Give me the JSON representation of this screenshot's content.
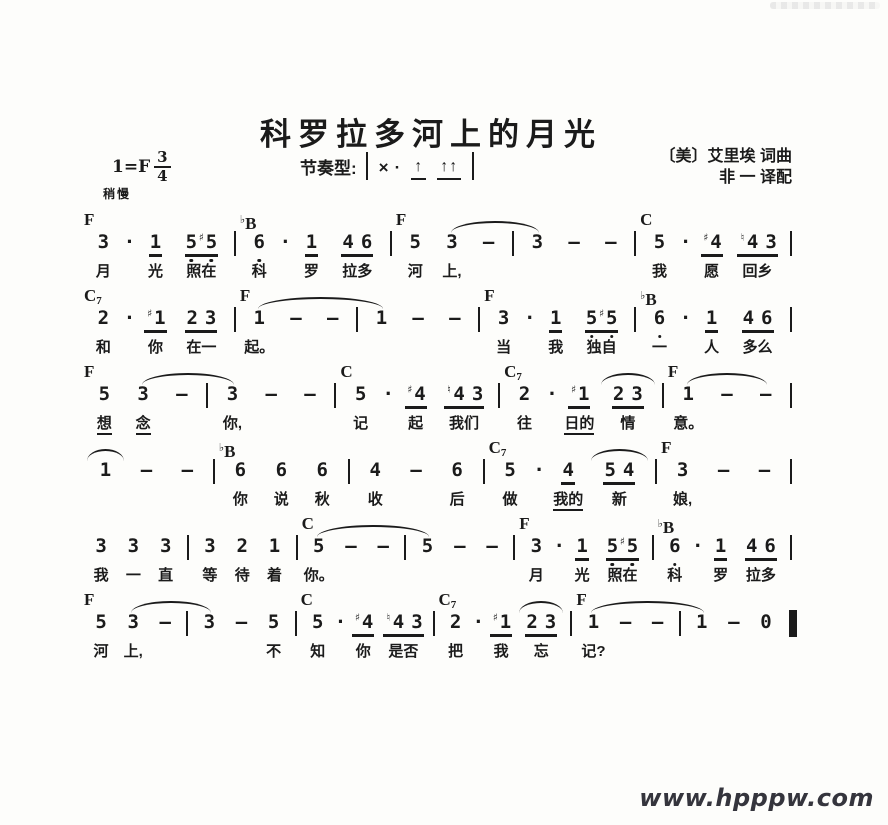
{
  "page": {
    "title": "科罗拉多河上的月光",
    "key_signature": "1=F",
    "time_numerator": "3",
    "time_denominator": "4",
    "tempo": "稍慢",
    "rhythm": {
      "label": "节奏型:",
      "x": "×",
      "dot": "·",
      "arrow": "↑",
      "arrow_pair": "↑↑"
    },
    "credit_line1": "〔美〕艾里埃 词曲",
    "credit_line2": "非 一 译配",
    "watermark": "www.hpppw.com",
    "colors": {
      "ink": "#1b1b1b",
      "paper": "#fdfdfb",
      "watermark": "#35353d"
    }
  },
  "systems": [
    {
      "chords": [
        {
          "t": "F",
          "at": 0
        },
        {
          "t": "♭B",
          "at": 5
        },
        {
          "t": "F",
          "at": 10
        },
        {
          "t": "C",
          "at": 18
        }
      ],
      "ties": [
        {
          "from": 11,
          "to": 14
        }
      ],
      "tokens": [
        {
          "v": "3",
          "ly": "月"
        },
        {
          "v": "·"
        },
        {
          "v": "1",
          "u": 1,
          "ly": "光"
        },
        {
          "v": "5♯5",
          "u": 1,
          "low": 1,
          "ly": "照在"
        },
        {
          "b": 1
        },
        {
          "v": "6",
          "low": 1,
          "ly": "科"
        },
        {
          "v": "·"
        },
        {
          "v": "1",
          "u": 1,
          "ly": "罗"
        },
        {
          "v": "4 6",
          "u": 1,
          "ly": "拉多"
        },
        {
          "b": 1
        },
        {
          "v": "5",
          "ly": "河"
        },
        {
          "v": "3",
          "ly": "上,"
        },
        {
          "v": "—"
        },
        {
          "b": 1
        },
        {
          "v": "3"
        },
        {
          "v": "—"
        },
        {
          "v": "—"
        },
        {
          "b": 1
        },
        {
          "v": "5",
          "ly": "我"
        },
        {
          "v": "·"
        },
        {
          "v": "♯4",
          "u": 1,
          "ly": "愿"
        },
        {
          "v": "♮4 3",
          "u": 1,
          "ly": "回乡"
        },
        {
          "b": 1
        }
      ]
    },
    {
      "chords": [
        {
          "t": "C7",
          "at": 0
        },
        {
          "t": "F",
          "at": 5
        },
        {
          "t": "F",
          "at": 13
        },
        {
          "t": "♭B",
          "at": 18
        }
      ],
      "ties": [
        {
          "from": 5,
          "to": 9
        }
      ],
      "tokens": [
        {
          "v": "2",
          "ly": "和"
        },
        {
          "v": "·"
        },
        {
          "v": "♯1",
          "u": 1,
          "ly": "你"
        },
        {
          "v": "2 3",
          "u": 1,
          "ly": "在一"
        },
        {
          "b": 1
        },
        {
          "v": "1",
          "ly": "起。"
        },
        {
          "v": "—"
        },
        {
          "v": "—"
        },
        {
          "b": 1
        },
        {
          "v": "1"
        },
        {
          "v": "—"
        },
        {
          "v": "—"
        },
        {
          "b": 1
        },
        {
          "v": "3",
          "ly": "当"
        },
        {
          "v": "·"
        },
        {
          "v": "1",
          "u": 1,
          "ly": "我"
        },
        {
          "v": "5♯5",
          "u": 1,
          "low": 1,
          "ly": "独自"
        },
        {
          "b": 1
        },
        {
          "v": "6",
          "low": 1,
          "ly": "一"
        },
        {
          "v": "·"
        },
        {
          "v": "1",
          "u": 1,
          "ly": "人"
        },
        {
          "v": "4 6",
          "u": 1,
          "ly": "多么"
        },
        {
          "b": 1
        }
      ]
    },
    {
      "chords": [
        {
          "t": "F",
          "at": 0
        },
        {
          "t": "C",
          "at": 8
        },
        {
          "t": "C7",
          "at": 13
        },
        {
          "t": "F",
          "at": 18
        }
      ],
      "ties": [
        {
          "from": 1,
          "to": 4
        },
        {
          "from": 16,
          "to": 16
        },
        {
          "from": 18,
          "to": 20
        }
      ],
      "tokens": [
        {
          "v": "5",
          "ly": "想",
          "lyu": 1
        },
        {
          "v": "3",
          "ly": "念",
          "lyu": 1
        },
        {
          "v": "—"
        },
        {
          "b": 1
        },
        {
          "v": "3",
          "ly": "你,"
        },
        {
          "v": "—"
        },
        {
          "v": "—"
        },
        {
          "b": 1
        },
        {
          "v": "5",
          "ly": "记"
        },
        {
          "v": "·"
        },
        {
          "v": "♯4",
          "u": 1,
          "ly": "起"
        },
        {
          "v": "♮4 3",
          "u": 1,
          "ly": "我们"
        },
        {
          "b": 1
        },
        {
          "v": "2",
          "ly": "往"
        },
        {
          "v": "·"
        },
        {
          "v": "♯1",
          "u": 1,
          "ly": "日的",
          "lyu": 1
        },
        {
          "v": "2 3",
          "u": 1,
          "ly": "情"
        },
        {
          "b": 1
        },
        {
          "v": "1",
          "ly": "意。"
        },
        {
          "v": "—"
        },
        {
          "v": "—"
        },
        {
          "b": 1
        }
      ]
    },
    {
      "chords": [
        {
          "t": "♭B",
          "at": 4
        },
        {
          "t": "C7",
          "at": 12
        },
        {
          "t": "F",
          "at": 17
        }
      ],
      "ties": [
        {
          "from": 0,
          "to": 0
        },
        {
          "from": 15,
          "to": 15
        }
      ],
      "tokens": [
        {
          "v": "1"
        },
        {
          "v": "—"
        },
        {
          "v": "—"
        },
        {
          "b": 1
        },
        {
          "v": "6",
          "ly": "你"
        },
        {
          "v": "6",
          "ly": "说"
        },
        {
          "v": "6",
          "ly": "秋"
        },
        {
          "b": 1
        },
        {
          "v": "4",
          "ly": "收"
        },
        {
          "v": "—"
        },
        {
          "v": "6",
          "ly": "后"
        },
        {
          "b": 1
        },
        {
          "v": "5",
          "ly": "做"
        },
        {
          "v": "·"
        },
        {
          "v": "4",
          "u": 1,
          "ly": "我的",
          "lyu": 1
        },
        {
          "v": "5 4",
          "u": 1,
          "ly": "新"
        },
        {
          "b": 1
        },
        {
          "v": "3",
          "ly": "娘,"
        },
        {
          "v": "—"
        },
        {
          "v": "—"
        },
        {
          "b": 1
        }
      ]
    },
    {
      "chords": [
        {
          "t": "C",
          "at": 8
        },
        {
          "t": "F",
          "at": 16
        },
        {
          "t": "♭B",
          "at": 21
        }
      ],
      "ties": [
        {
          "from": 8,
          "to": 12
        }
      ],
      "tokens": [
        {
          "v": "3",
          "ly": "我"
        },
        {
          "v": "3",
          "ly": "一"
        },
        {
          "v": "3",
          "ly": "直"
        },
        {
          "b": 1
        },
        {
          "v": "3",
          "ly": "等"
        },
        {
          "v": "2",
          "ly": "待"
        },
        {
          "v": "1",
          "ly": "着"
        },
        {
          "b": 1
        },
        {
          "v": "5",
          "ly": "你。"
        },
        {
          "v": "—"
        },
        {
          "v": "—"
        },
        {
          "b": 1
        },
        {
          "v": "5"
        },
        {
          "v": "—"
        },
        {
          "v": "—"
        },
        {
          "b": 1
        },
        {
          "v": "3",
          "ly": "月"
        },
        {
          "v": "·"
        },
        {
          "v": "1",
          "u": 1,
          "ly": "光"
        },
        {
          "v": "5♯5",
          "u": 1,
          "low": 1,
          "ly": "照在"
        },
        {
          "b": 1
        },
        {
          "v": "6",
          "low": 1,
          "ly": "科"
        },
        {
          "v": "·"
        },
        {
          "v": "1",
          "u": 1,
          "ly": "罗"
        },
        {
          "v": "4 6",
          "u": 1,
          "ly": "拉多"
        },
        {
          "b": 1
        }
      ]
    },
    {
      "chords": [
        {
          "t": "F",
          "at": 0
        },
        {
          "t": "C",
          "at": 8
        },
        {
          "t": "C7",
          "at": 13
        },
        {
          "t": "F",
          "at": 18
        }
      ],
      "ties": [
        {
          "from": 1,
          "to": 4
        },
        {
          "from": 16,
          "to": 16
        },
        {
          "from": 18,
          "to": 22
        }
      ],
      "tokens": [
        {
          "v": "5",
          "ly": "河"
        },
        {
          "v": "3",
          "ly": "上,"
        },
        {
          "v": "—"
        },
        {
          "b": 1
        },
        {
          "v": "3"
        },
        {
          "v": "—"
        },
        {
          "v": "5",
          "ly": "不"
        },
        {
          "b": 1
        },
        {
          "v": "5",
          "ly": "知"
        },
        {
          "v": "·"
        },
        {
          "v": "♯4",
          "u": 1,
          "ly": "你"
        },
        {
          "v": "♮4 3",
          "u": 1,
          "ly": "是否"
        },
        {
          "b": 1
        },
        {
          "v": "2",
          "ly": "把"
        },
        {
          "v": "·"
        },
        {
          "v": "♯1",
          "u": 1,
          "ly": "我"
        },
        {
          "v": "2 3",
          "u": 1,
          "ly": "忘"
        },
        {
          "b": 1
        },
        {
          "v": "1",
          "ly": "记?"
        },
        {
          "v": "—"
        },
        {
          "v": "—"
        },
        {
          "b": 1
        },
        {
          "v": "1"
        },
        {
          "v": "—"
        },
        {
          "v": "0"
        },
        {
          "eb": 1
        }
      ]
    }
  ]
}
